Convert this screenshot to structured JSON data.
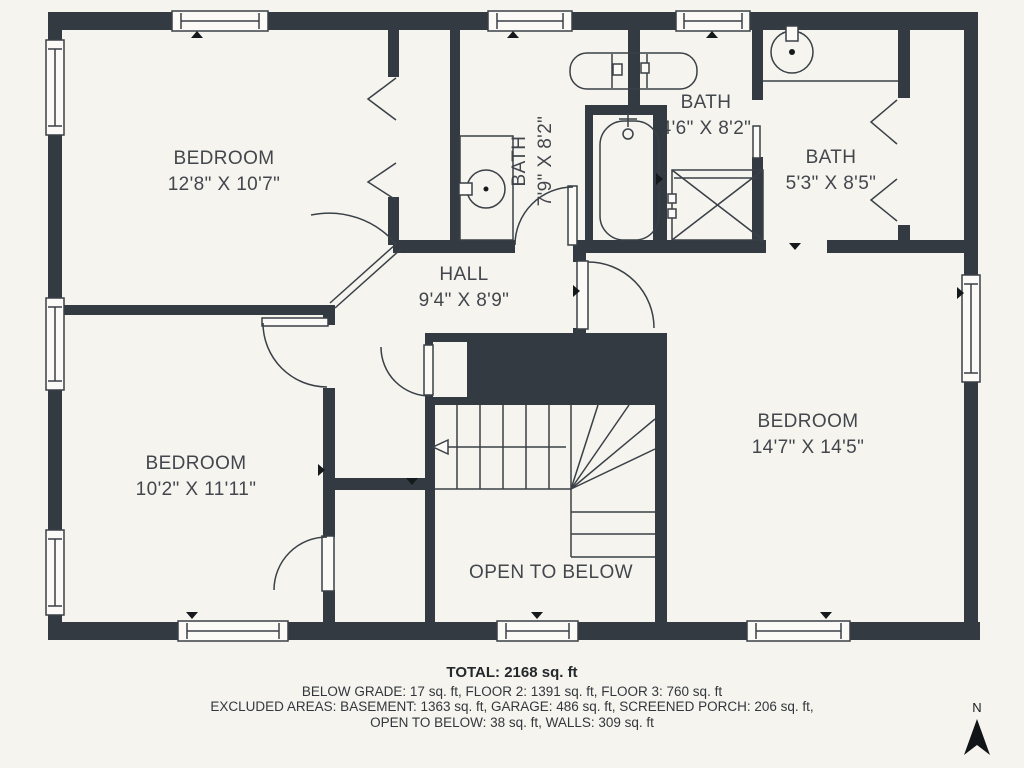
{
  "title": "Third floor plan",
  "colors": {
    "background": "#f5f4ee",
    "wall": "#333a41",
    "line": "#3a4047",
    "text": "#43474d"
  },
  "rooms": [
    {
      "name": "BEDROOM",
      "dims": "12'8\" X 10'7\""
    },
    {
      "name": "BATH",
      "dims": "7'9\" X 8'2\""
    },
    {
      "name": "BATH",
      "dims": "4'6\" X 8'2\""
    },
    {
      "name": "BATH",
      "dims": "5'3\" X 8'5\""
    },
    {
      "name": "HALL",
      "dims": "9'4\" X 8'9\""
    },
    {
      "name": "BEDROOM",
      "dims": "10'2\" X 11'11\""
    },
    {
      "name": "BEDROOM",
      "dims": "14'7\" X 14'5\""
    },
    {
      "name": "OPEN TO BELOW",
      "dims": ""
    }
  ],
  "fixtures": [
    "bathtub-icon",
    "shower-icon",
    "sink-icon",
    "double-vanity-icon",
    "stairs",
    "door-arcs",
    "bifold-doors",
    "window-symbols"
  ],
  "footer": {
    "total": "TOTAL: 2168 sq. ft",
    "line2": "BELOW GRADE: 17 sq. ft, FLOOR 2: 1391 sq. ft, FLOOR 3: 760 sq. ft",
    "line3": "EXCLUDED AREAS: BASEMENT: 1363 sq. ft, GARAGE: 486 sq. ft, SCREENED PORCH: 206 sq. ft,",
    "line4": "OPEN TO BELOW: 38 sq. ft, WALLS: 309 sq. ft"
  },
  "compass": {
    "label": "N"
  }
}
